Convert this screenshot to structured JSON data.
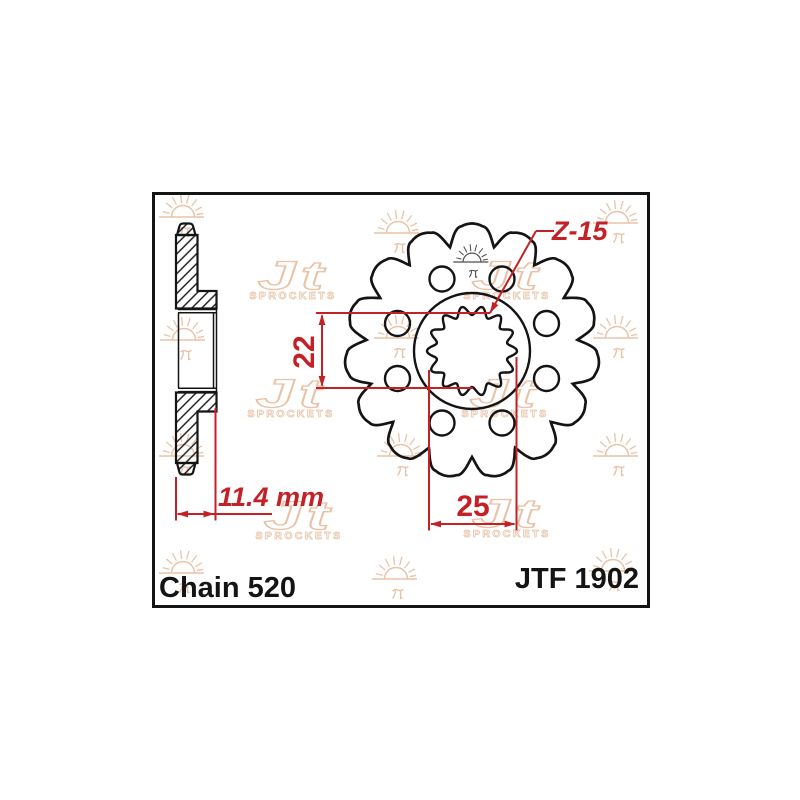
{
  "labels": {
    "chain": "Chain 520",
    "part_number": "JTF 1902"
  },
  "dimensions": {
    "bore_height": "22",
    "bore_width": "25",
    "overall_width": "11.4 mm",
    "teeth_count": "Z-15"
  },
  "watermark": {
    "brand_word": "SPROCKETS",
    "logo_monogram": "Jt",
    "suns": [
      {
        "x": 183,
        "y": 217
      },
      {
        "x": 398,
        "y": 233
      },
      {
        "x": 617,
        "y": 223
      },
      {
        "x": 184,
        "y": 340
      },
      {
        "x": 398,
        "y": 338
      },
      {
        "x": 617,
        "y": 338
      },
      {
        "x": 183,
        "y": 456
      },
      {
        "x": 401,
        "y": 456
      },
      {
        "x": 617,
        "y": 456
      },
      {
        "x": 183,
        "y": 573
      },
      {
        "x": 396,
        "y": 579
      },
      {
        "x": 613,
        "y": 571
      }
    ],
    "dark_sun": {
      "x": 472,
      "y": 262,
      "scale": 0.78
    },
    "logos": [
      {
        "x": 293,
        "y": 276
      },
      {
        "x": 507,
        "y": 276
      },
      {
        "x": 291,
        "y": 394
      },
      {
        "x": 505,
        "y": 394
      },
      {
        "x": 299,
        "y": 516
      },
      {
        "x": 507,
        "y": 514
      }
    ]
  },
  "colors": {
    "dimension_red": "#c42127",
    "outline_black": "#141414",
    "watermark_peach": "#e9c3a8",
    "dark_sun_gray": "#4d4d4d",
    "background": "#ffffff"
  },
  "drawing": {
    "frame": {
      "x": 153.5,
      "y": 193.5,
      "w": 495,
      "h": 413
    },
    "front": {
      "cx": 472,
      "cy": 351,
      "teeth": 15,
      "r_tip": 127.5,
      "r_root": 106,
      "tip_half_deg": 5,
      "r_hub": 58,
      "spline": {
        "base": 40.5,
        "amp": 4.5,
        "lobes": 14
      },
      "holes": {
        "r": 12.5,
        "offsets": [
          [
            30,
            -72
          ],
          [
            -30,
            -72
          ],
          [
            74.5,
            -27.5
          ],
          [
            -74.5,
            -27.5
          ],
          [
            74.5,
            27.5
          ],
          [
            -74.5,
            27.5
          ],
          [
            30,
            72
          ],
          [
            -30,
            72
          ]
        ]
      }
    },
    "side": {
      "tip_top": "M177,235 L179.5,226 Q180.2,223.5 183.2,223.5 L189.3,223.5 Q192.3,223.5 193,226 L195.5,235 Z",
      "body_top": "M176,235 L197.5,235 L197.5,291 L216.5,291 L216.5,308.5 L176,308.5 Z",
      "body_bottom": "M176,392.5 L216.5,392.5 L216.5,411.5 L197.5,411.5 L197.5,463 L176,463 Z",
      "tip_bottom": "M177,463 L195.5,463 L193,472.5 Q192.3,474.5 189.3,474.5 L183.2,474.5 Q180.2,474.5 179.5,472.5 Z",
      "thin_lines": [
        [
          178,
          309.5,
          216,
          309.5
        ],
        [
          178,
          312.8,
          216,
          312.8
        ],
        [
          178,
          388.3,
          216,
          388.3
        ],
        [
          178,
          391.6,
          216,
          391.6
        ],
        [
          178.5,
          313,
          178.5,
          388
        ],
        [
          213.5,
          313,
          213.5,
          388
        ],
        [
          216.5,
          308.5,
          216.5,
          392.5
        ]
      ]
    },
    "red": {
      "lines": [
        [
          322,
          315.5,
          322,
          385.5
        ],
        [
          316,
          313,
          490,
          313
        ],
        [
          316,
          388,
          473,
          388
        ],
        [
          431,
          524,
          514.5,
          524
        ],
        [
          429,
          370,
          429,
          530.5
        ],
        [
          516.5,
          357,
          516.5,
          530.5
        ],
        [
          176,
          477,
          176,
          520.5
        ],
        [
          215.5,
          408,
          215.5,
          520.5
        ],
        [
          177.5,
          514,
          272,
          514
        ],
        [
          490,
          313,
          536,
          231
        ],
        [
          536,
          231,
          554,
          231
        ]
      ],
      "arrows": [
        [
          322,
          314,
          -90
        ],
        [
          322,
          387,
          90
        ],
        [
          430,
          524,
          180
        ],
        [
          515.5,
          524,
          0
        ],
        [
          177,
          514,
          180
        ],
        [
          214.5,
          514,
          0
        ],
        [
          490,
          313,
          119.3
        ]
      ]
    }
  }
}
